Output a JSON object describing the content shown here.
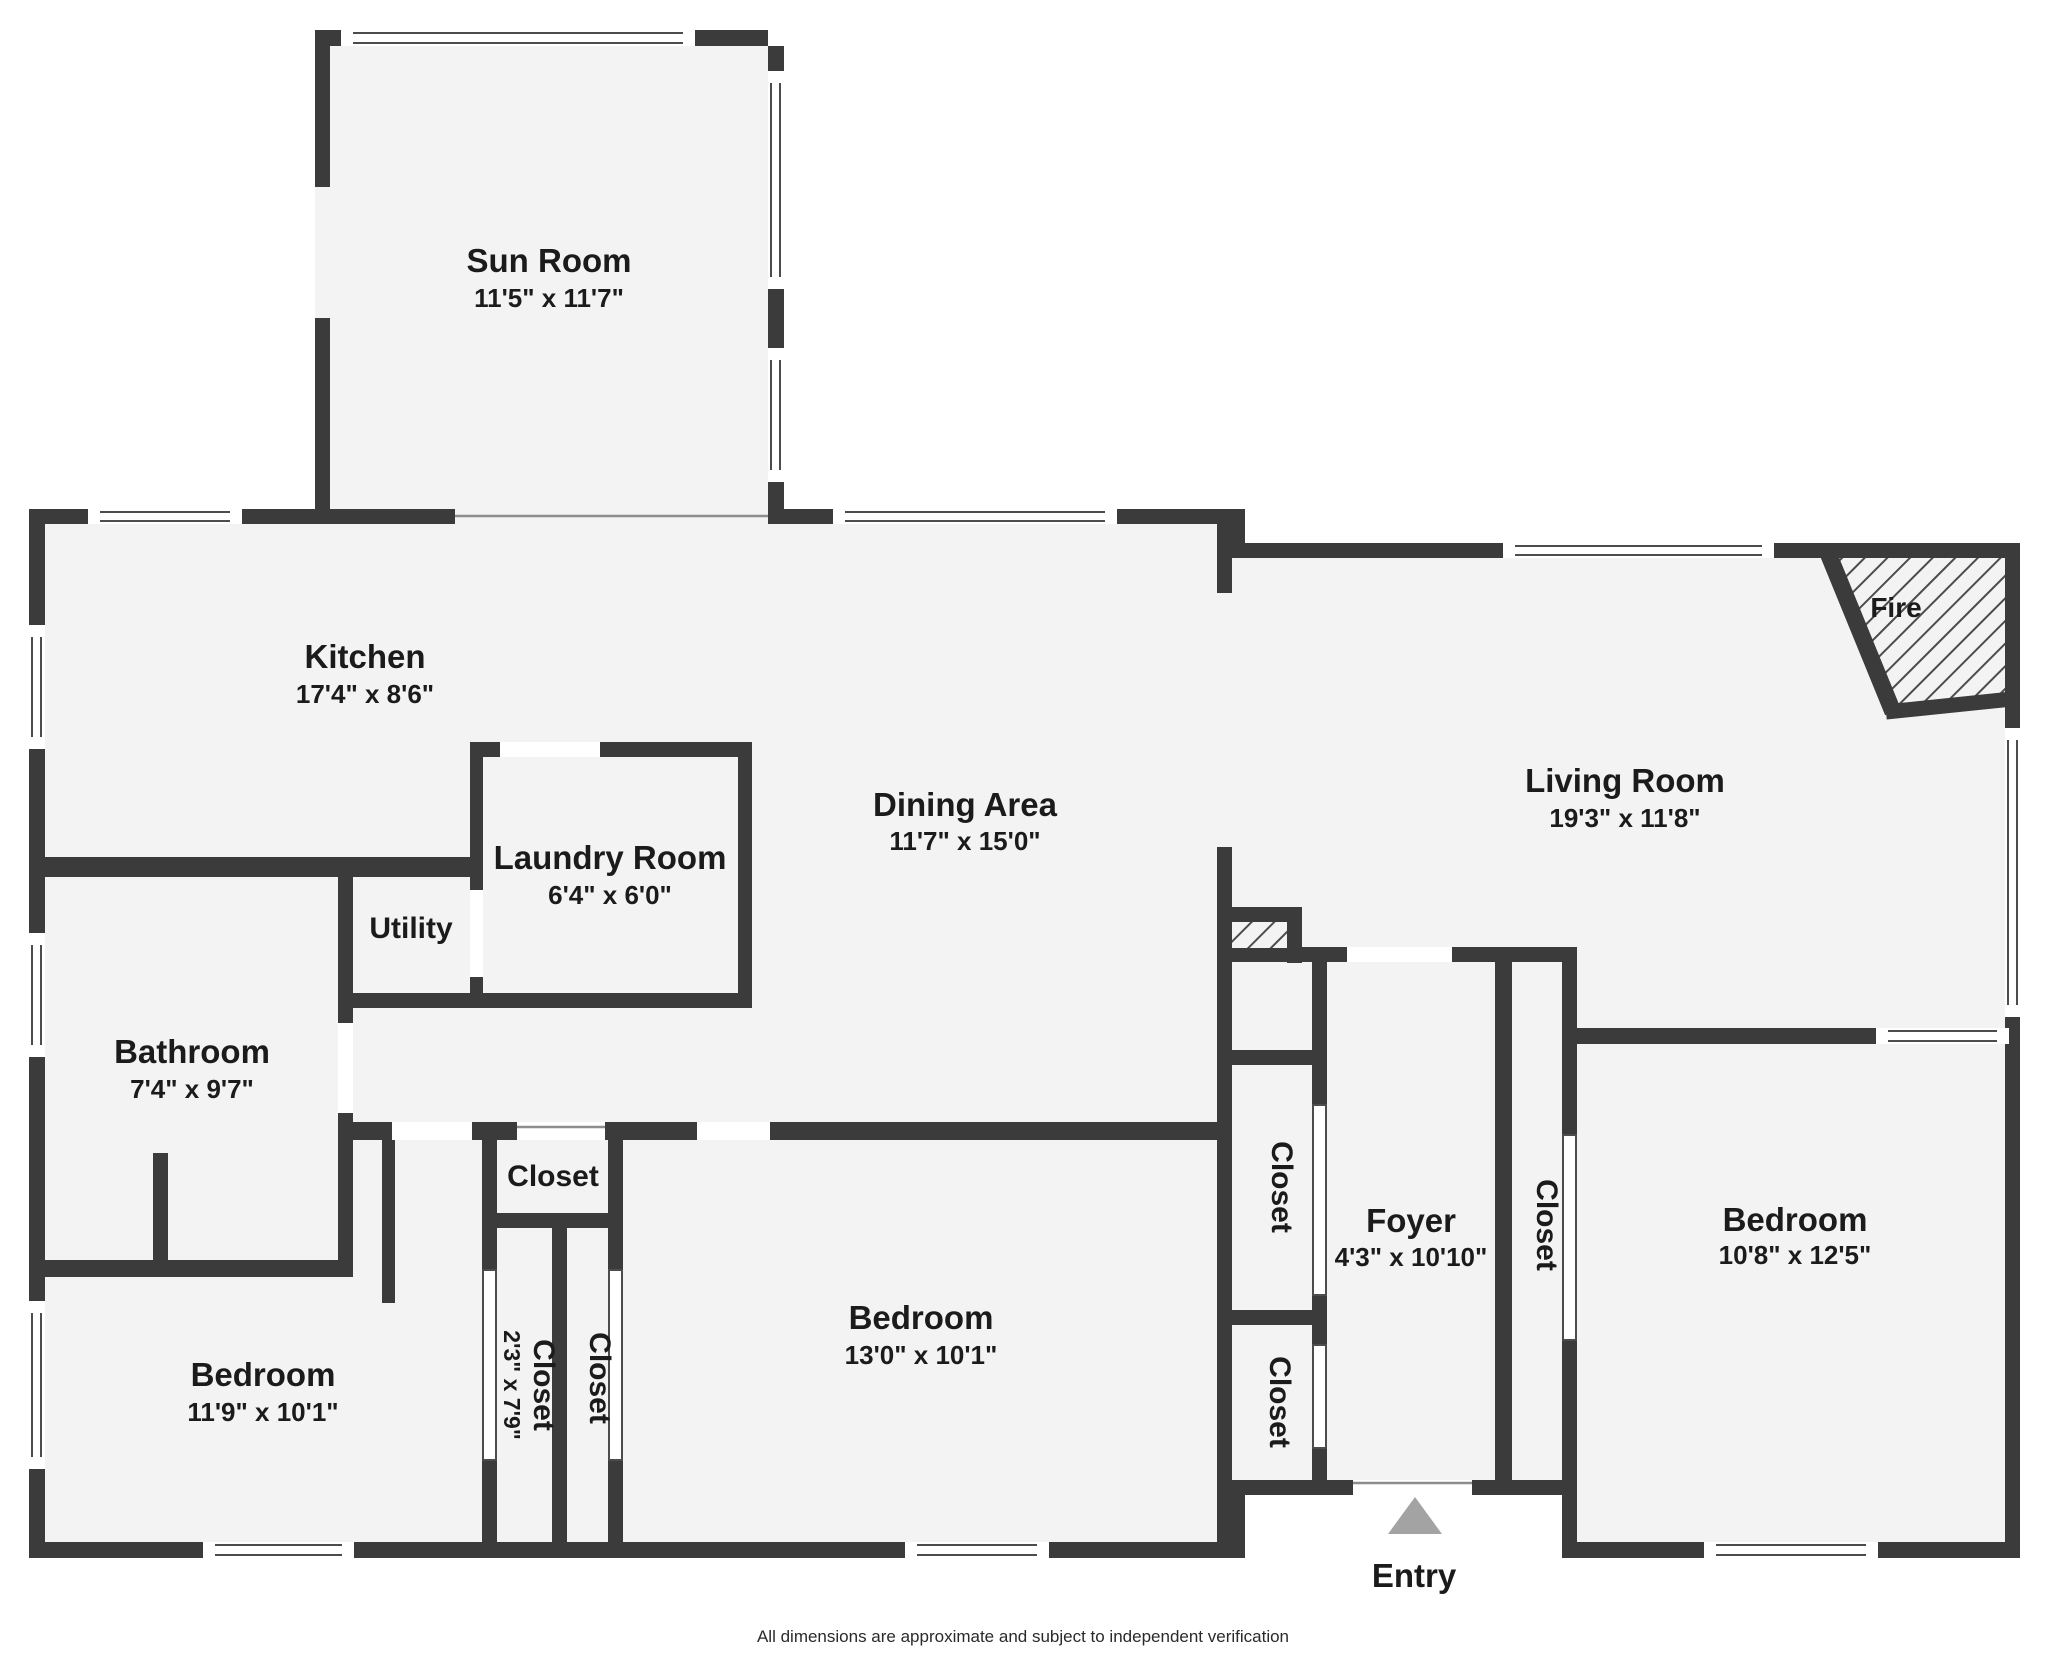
{
  "colors": {
    "wall": "#3b3b3b",
    "floor": "#f3f3f3",
    "window_line": "#4c4c4c",
    "entry_arrow": "#a3a3a3",
    "text": "#1b1b1b"
  },
  "rooms": {
    "sun_room": {
      "name": "Sun Room",
      "dims": "11'5\" x 11'7\""
    },
    "kitchen": {
      "name": "Kitchen",
      "dims": "17'4\" x 8'6\""
    },
    "laundry": {
      "name": "Laundry Room",
      "dims": "6'4\" x 6'0\""
    },
    "utility": {
      "name": "Utility"
    },
    "dining": {
      "name": "Dining Area",
      "dims": "11'7\" x 15'0\""
    },
    "living": {
      "name": "Living Room",
      "dims": "19'3\" x 11'8\""
    },
    "fireplace": {
      "name": "Fire"
    },
    "bathroom": {
      "name": "Bathroom",
      "dims": "7'4\" x 9'7\""
    },
    "closet_hall": {
      "name": "Closet"
    },
    "closet_left_a": {
      "name": "Closet",
      "dims": "2'3\" x 7'9\""
    },
    "closet_left_b": {
      "name": "Closet"
    },
    "bedroom_left": {
      "name": "Bedroom",
      "dims": "11'9\" x 10'1\""
    },
    "bedroom_middle": {
      "name": "Bedroom",
      "dims": "13'0\" x 10'1\""
    },
    "bedroom_right": {
      "name": "Bedroom",
      "dims": "10'8\" x 12'5\""
    },
    "foyer": {
      "name": "Foyer",
      "dims": "4'3\" x 10'10\""
    },
    "closet_foyer_upper": {
      "name": "Closet"
    },
    "closet_foyer_lower": {
      "name": "Closet"
    },
    "closet_foyer_right": {
      "name": "Closet"
    }
  },
  "entry": {
    "label": "Entry"
  },
  "footer": {
    "disclaimer": "All dimensions are approximate and subject to independent verification"
  }
}
